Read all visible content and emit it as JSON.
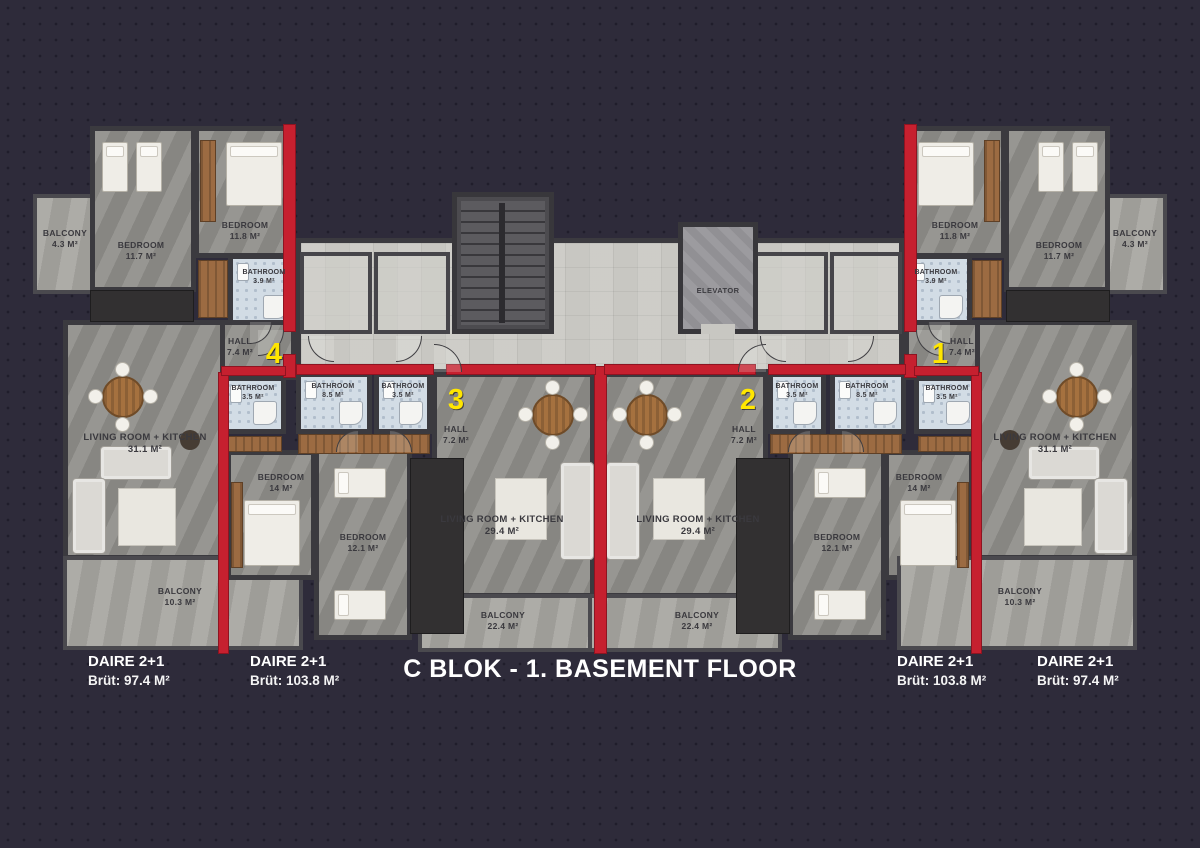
{
  "title": "C BLOK - 1. BASEMENT FLOOR",
  "core": {
    "elevator": "ELEVATOR"
  },
  "badges": {
    "unit1": "1",
    "unit2": "2",
    "unit3": "3",
    "unit4": "4"
  },
  "colors": {
    "accent_red": "#c6202f",
    "badge_yellow": "#ffe600",
    "background": "#2e2b3a"
  },
  "captions": [
    {
      "type": "DAIRE 2+1",
      "area": "Brüt: 97.4 M²"
    },
    {
      "type": "DAIRE 2+1",
      "area": "Brüt: 103.8 M²"
    },
    {
      "type": "DAIRE 2+1",
      "area": "Brüt: 103.8 M²"
    },
    {
      "type": "DAIRE 2+1",
      "area": "Brüt: 97.4 M²"
    }
  ],
  "rooms": {
    "u4": {
      "bedroom_a": {
        "name": "BEDROOM",
        "area": "11.7 M²"
      },
      "bedroom_b": {
        "name": "BEDROOM",
        "area": "11.8 M²"
      },
      "balcony_a": {
        "name": "BALCONY",
        "area": "4.3 M²"
      },
      "bathroom_a": {
        "name": "BATHROOM",
        "area": "3.9 M²"
      },
      "hall": {
        "name": "HALL",
        "area": "7.4 M²"
      },
      "bathroom_b": {
        "name": "BATHROOM",
        "area": "3.5 M²"
      },
      "living": {
        "name": "LIVING ROOM + KITCHEN",
        "area": "31.1 M²"
      },
      "balcony_b": {
        "name": "BALCONY",
        "area": "10.3 M²"
      }
    },
    "u3": {
      "bathroom_a": {
        "name": "BATHROOM",
        "area": "8.5 M²"
      },
      "bathroom_b": {
        "name": "BATHROOM",
        "area": "3.5 M²"
      },
      "hall": {
        "name": "HALL",
        "area": "7.2 M²"
      },
      "bedroom_a": {
        "name": "BEDROOM",
        "area": "14 M²"
      },
      "bedroom_b": {
        "name": "BEDROOM",
        "area": "12.1 M²"
      },
      "living": {
        "name": "LIVING ROOM + KITCHEN",
        "area": "29.4 M²"
      },
      "balcony": {
        "name": "BALCONY",
        "area": "22.4 M²"
      }
    },
    "u2": {
      "bathroom_a": {
        "name": "BATHROOM",
        "area": "8.5 M²"
      },
      "bathroom_b": {
        "name": "BATHROOM",
        "area": "3.5 M²"
      },
      "hall": {
        "name": "HALL",
        "area": "7.2 M²"
      },
      "bedroom_a": {
        "name": "BEDROOM",
        "area": "14 M²"
      },
      "bedroom_b": {
        "name": "BEDROOM",
        "area": "12.1 M²"
      },
      "living": {
        "name": "LIVING ROOM + KITCHEN",
        "area": "29.4 M²"
      },
      "balcony": {
        "name": "BALCONY",
        "area": "22.4 M²"
      }
    },
    "u1": {
      "bedroom_a": {
        "name": "BEDROOM",
        "area": "11.7 M²"
      },
      "bedroom_b": {
        "name": "BEDROOM",
        "area": "11.8 M²"
      },
      "balcony_a": {
        "name": "BALCONY",
        "area": "4.3 M²"
      },
      "bathroom_a": {
        "name": "BATHROOM",
        "area": "3.9 M²"
      },
      "hall": {
        "name": "HALL",
        "area": "7.4 M²"
      },
      "bathroom_b": {
        "name": "BATHROOM",
        "area": "3.5 M²"
      },
      "living": {
        "name": "LIVING ROOM + KITCHEN",
        "area": "31.1 M²"
      },
      "balcony_b": {
        "name": "BALCONY",
        "area": "10.3 M²"
      }
    }
  }
}
